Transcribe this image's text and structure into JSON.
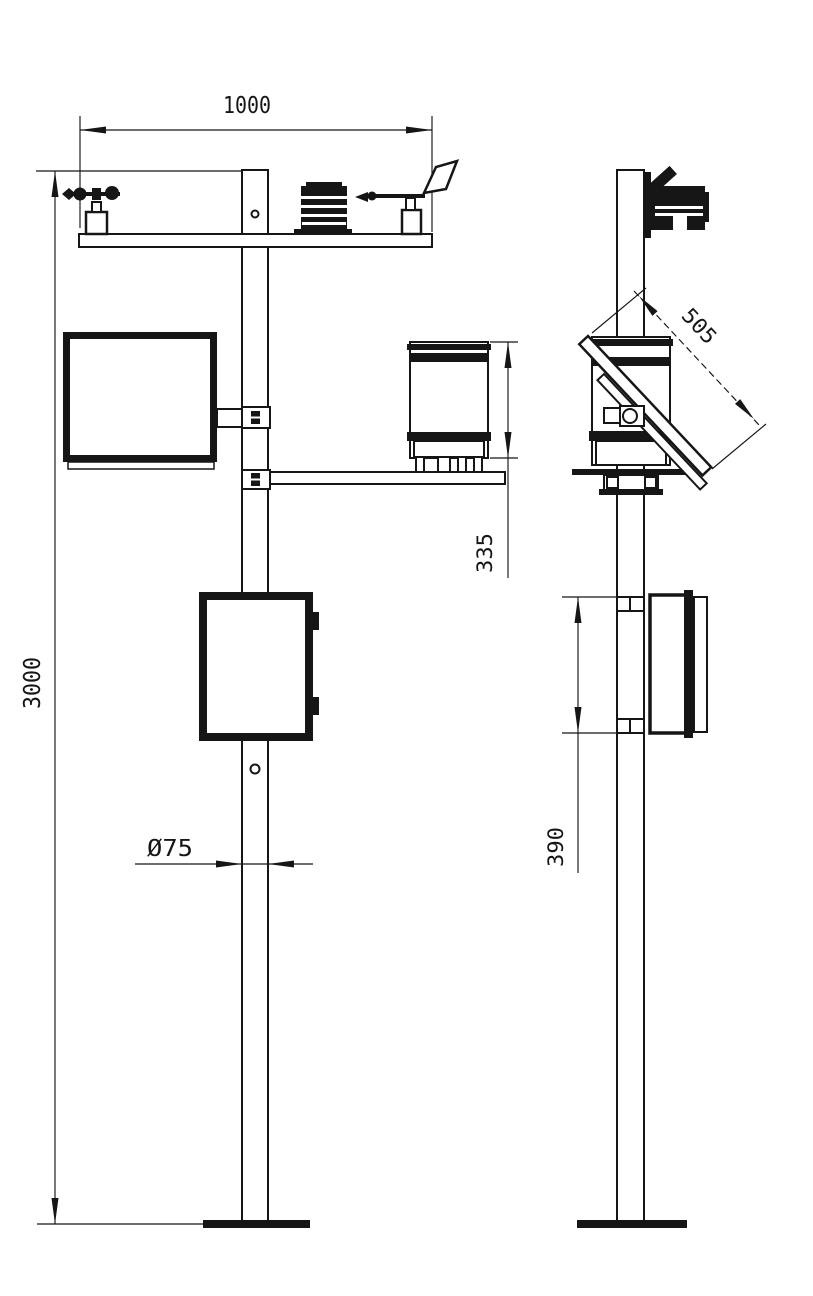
{
  "drawing": {
    "background": "#ffffff",
    "line_color": "#161616",
    "dims": {
      "crossbar_width": "1000",
      "pole_height": "3000",
      "pole_diameter": "Ø75",
      "rain_gauge_height": "335",
      "solar_panel_length": "505",
      "control_box_height": "390"
    }
  }
}
